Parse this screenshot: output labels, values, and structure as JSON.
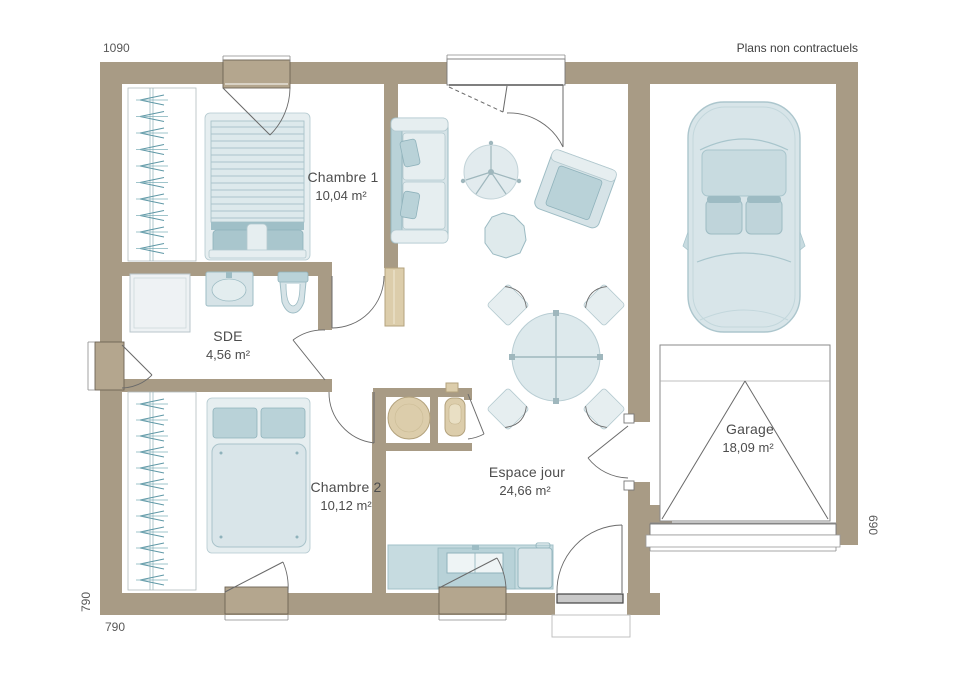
{
  "meta": {
    "disclaimer": "Plans non contractuels"
  },
  "dimensions": {
    "top": "1090",
    "left_vertical": "790",
    "bottom": "790",
    "right_vertical": "690"
  },
  "rooms": [
    {
      "name": "Chambre 1",
      "area": "10,04 m²"
    },
    {
      "name": "SDE",
      "area": "4,56 m²"
    },
    {
      "name": "Chambre 2",
      "area": "10,12 m²"
    },
    {
      "name": "Espace jour",
      "area": "24,66 m²"
    },
    {
      "name": "Garage",
      "area": "18,09 m²"
    }
  ],
  "colors": {
    "wall": "#a89b85",
    "window_frame": "#b4a68e",
    "furniture_blue": "#d6e3e7",
    "furniture_blue_accent": "#b9d2d8",
    "furniture_tan": "#dccdab",
    "hanger_teal": "#5f98a6",
    "line": "#6a6a6a",
    "text": "#4d4d4d"
  }
}
